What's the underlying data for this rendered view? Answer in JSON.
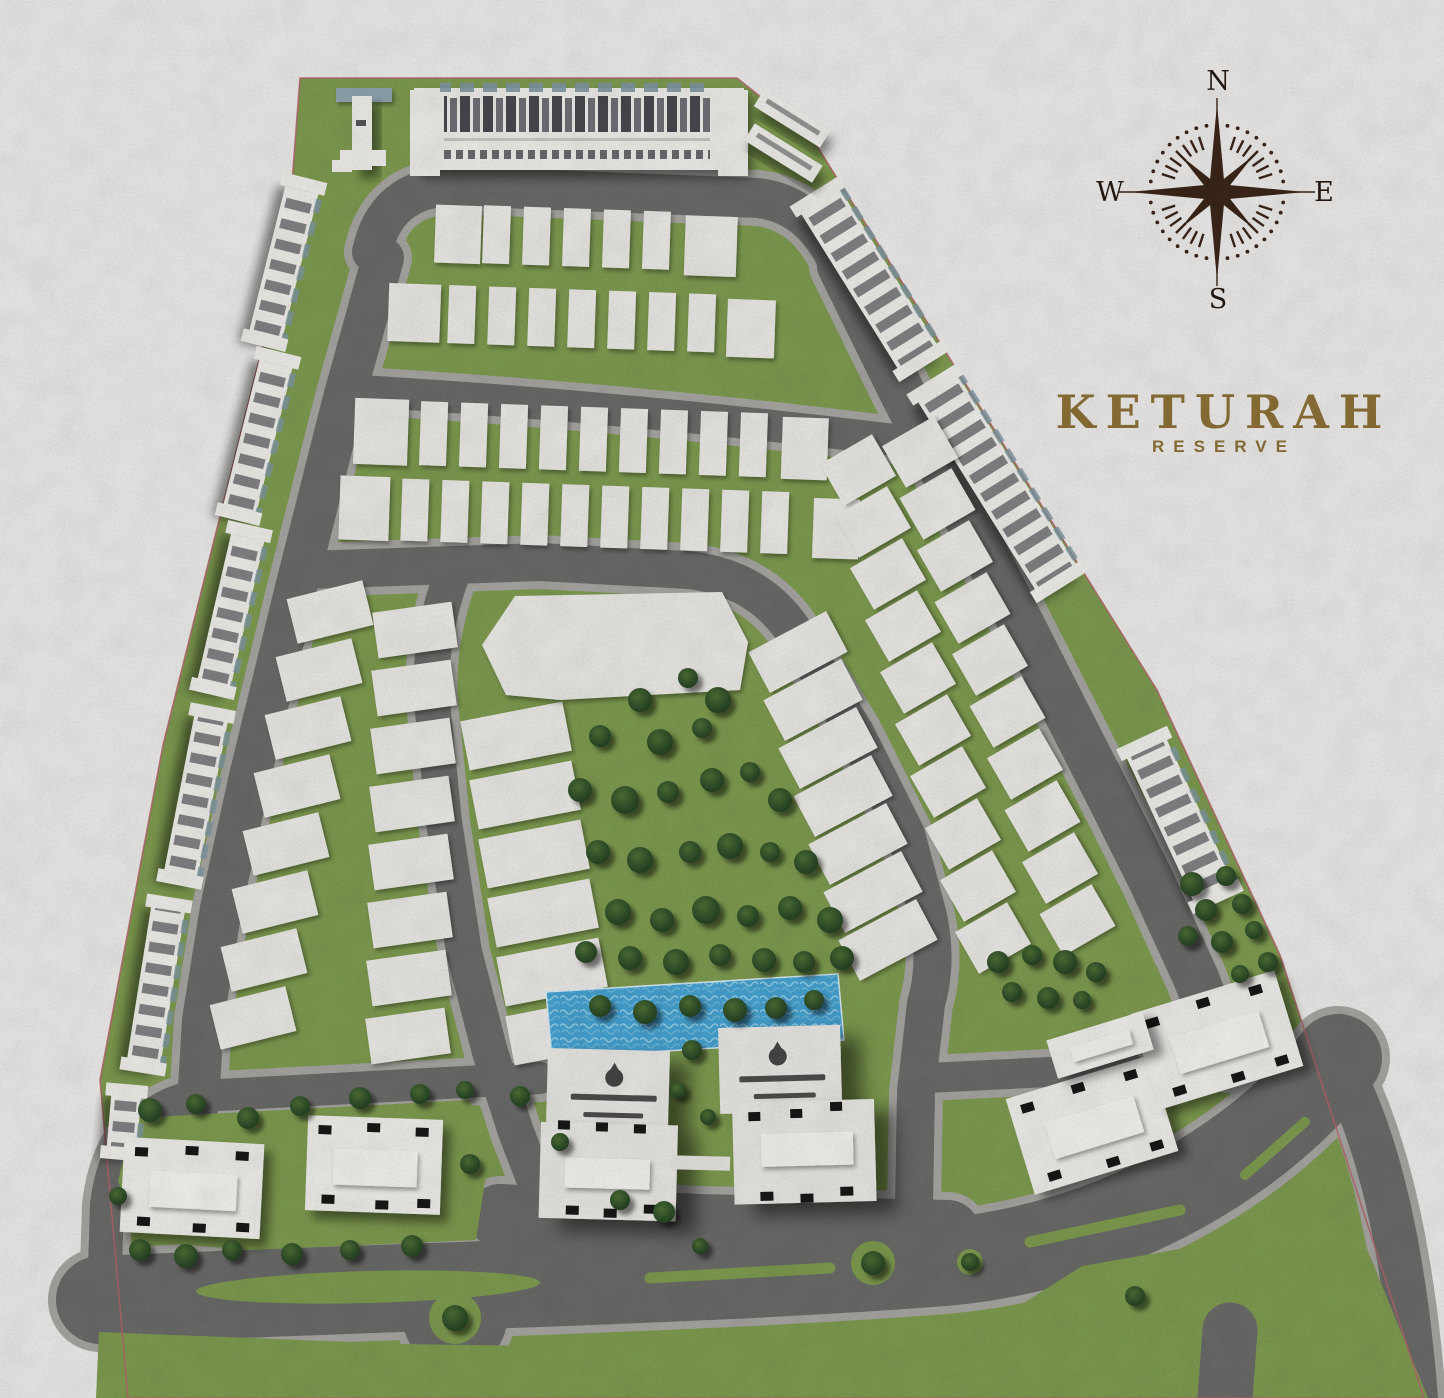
{
  "brand": {
    "title": "KETURAH",
    "subtitle": "RESERVE"
  },
  "compass": {
    "labels": {
      "north": "N",
      "east": "E",
      "south": "S",
      "west": "W"
    }
  },
  "colors": {
    "background": "#edecea",
    "grass": "#7e9b4f",
    "asphalt": "#6a6a68",
    "sidewalk": "#a7a6a2",
    "plot": "#eceae6",
    "building": "#efeeea",
    "window": "#55565b",
    "roof_accent": "#7d96a4",
    "pool": "#45a2d1",
    "pool_light": "#b7e4f5",
    "tree": "#2c4a27",
    "boundary": "#b4646b",
    "compass": "#3a2418",
    "logo": "#8c7036"
  },
  "map": {
    "site_outline_points": "300,78 737,78 812,138 1157,690 1280,955 1424,1398 128,1398 100,1080 163,745 287,248",
    "central_plot_points": "515,596 722,592 748,642 740,690 560,700 506,695 482,645",
    "pool_points": "546,992 838,974 844,1040 552,1058",
    "plot_rows": [
      {
        "lead": [
          436,
          204,
          46,
          58
        ],
        "x": 484,
        "y": 203,
        "w": 27,
        "h": 58,
        "n": 5,
        "p": 40,
        "tail": [
          686,
          206,
          52,
          60
        ]
      },
      {
        "lead": [
          392,
          284,
          52,
          58
        ],
        "x": 452,
        "y": 284,
        "w": 27,
        "h": 58,
        "n": 7,
        "p": 40,
        "tail": [
          731,
          288,
          48,
          58
        ]
      },
      {
        "lead": [
          362,
          400,
          54,
          66
        ],
        "x": 428,
        "y": 401,
        "w": 27,
        "h": 64,
        "n": 9,
        "p": 40,
        "tail": [
          790,
          404,
          46,
          62
        ]
      },
      {
        "lead": [
          350,
          478,
          50,
          64
        ],
        "x": 412,
        "y": 479,
        "w": 27,
        "h": 62,
        "n": 10,
        "p": 40,
        "tail": [
          824,
          484,
          46,
          60
        ]
      }
    ],
    "plot_grids": [
      {
        "cx": 330,
        "cy": 612,
        "dx": -11,
        "dy": 58,
        "n": 8,
        "w": 78,
        "h": 46,
        "rot": -14
      },
      {
        "cx": 415,
        "cy": 630,
        "dx": -1,
        "dy": 58,
        "n": 8,
        "w": 80,
        "h": 46,
        "rot": -8
      },
      {
        "cx": 516,
        "cy": 736,
        "dx": 9,
        "dy": 59,
        "n": 6,
        "w": 104,
        "h": 50,
        "rot": -11
      },
      {
        "cx": 798,
        "cy": 652,
        "dx": 15,
        "dy": 48,
        "n": 7,
        "w": 88,
        "h": 46,
        "rot": -28
      },
      {
        "cx": 858,
        "cy": 470,
        "dx": 15,
        "dy": 52,
        "n": 10,
        "w": 60,
        "h": 48,
        "rot": -30
      },
      {
        "cx": 920,
        "cy": 452,
        "dx": 17.5,
        "dy": 52,
        "n": 10,
        "w": 60,
        "h": 48,
        "rot": -30
      }
    ],
    "strips": [
      {
        "cx": 284,
        "cy": 262,
        "len": 162,
        "w": 34,
        "rot": 104
      },
      {
        "cx": 258,
        "cy": 436,
        "len": 162,
        "w": 34,
        "rot": 104
      },
      {
        "cx": 231,
        "cy": 610,
        "len": 162,
        "w": 34,
        "rot": 103
      },
      {
        "cx": 196,
        "cy": 796,
        "len": 170,
        "w": 34,
        "rot": 101
      },
      {
        "cx": 156,
        "cy": 985,
        "len": 166,
        "w": 34,
        "rot": 99
      },
      {
        "cx": 124,
        "cy": 1122,
        "len": 64,
        "w": 30,
        "rot": 95
      },
      {
        "cx": 869,
        "cy": 279,
        "len": 195,
        "w": 46,
        "rot": 58
      },
      {
        "cx": 997,
        "cy": 483,
        "len": 234,
        "w": 48,
        "rot": 58
      },
      {
        "cx": 1180,
        "cy": 820,
        "len": 170,
        "w": 44,
        "rot": 65
      }
    ],
    "pavilions": [
      {
        "cx": 192,
        "cy": 1188,
        "w": 140,
        "h": 95,
        "rot": 3
      },
      {
        "cx": 374,
        "cy": 1165,
        "w": 135,
        "h": 95,
        "rot": 2
      },
      {
        "cx": 1092,
        "cy": 1125,
        "w": 150,
        "h": 100,
        "rot": -17
      },
      {
        "cx": 1217,
        "cy": 1040,
        "w": 150,
        "h": 100,
        "rot": -17
      },
      {
        "cx": 1100,
        "cy": 1045,
        "w": 100,
        "h": 40,
        "rot": -17,
        "plain": true
      }
    ],
    "trees": [
      [
        640,
        700,
        12
      ],
      [
        688,
        678,
        10
      ],
      [
        718,
        700,
        13
      ],
      [
        600,
        736,
        11
      ],
      [
        660,
        742,
        13
      ],
      [
        702,
        728,
        10
      ],
      [
        580,
        790,
        12
      ],
      [
        625,
        800,
        14
      ],
      [
        668,
        792,
        11
      ],
      [
        712,
        780,
        12
      ],
      [
        750,
        772,
        10
      ],
      [
        780,
        800,
        12
      ],
      [
        598,
        852,
        12
      ],
      [
        640,
        860,
        13
      ],
      [
        690,
        852,
        11
      ],
      [
        730,
        846,
        13
      ],
      [
        770,
        852,
        10
      ],
      [
        806,
        862,
        12
      ],
      [
        618,
        912,
        13
      ],
      [
        662,
        920,
        12
      ],
      [
        706,
        910,
        14
      ],
      [
        748,
        916,
        11
      ],
      [
        790,
        908,
        12
      ],
      [
        830,
        920,
        13
      ],
      [
        586,
        952,
        11
      ],
      [
        630,
        958,
        12
      ],
      [
        676,
        962,
        13
      ],
      [
        720,
        955,
        11
      ],
      [
        764,
        960,
        12
      ],
      [
        804,
        962,
        11
      ],
      [
        842,
        958,
        12
      ],
      [
        600,
        1006,
        11
      ],
      [
        645,
        1012,
        12
      ],
      [
        690,
        1006,
        11
      ],
      [
        735,
        1010,
        12
      ],
      [
        776,
        1008,
        11
      ],
      [
        814,
        1000,
        10
      ],
      [
        692,
        1050,
        10
      ],
      [
        678,
        1090,
        8
      ],
      [
        708,
        1117,
        8
      ],
      [
        150,
        1110,
        12
      ],
      [
        196,
        1104,
        10
      ],
      [
        248,
        1118,
        11
      ],
      [
        300,
        1106,
        10
      ],
      [
        360,
        1098,
        11
      ],
      [
        420,
        1094,
        10
      ],
      [
        465,
        1090,
        9
      ],
      [
        140,
        1250,
        11
      ],
      [
        186,
        1256,
        12
      ],
      [
        232,
        1250,
        10
      ],
      [
        292,
        1254,
        11
      ],
      [
        350,
        1250,
        10
      ],
      [
        412,
        1246,
        11
      ],
      [
        118,
        1196,
        9
      ],
      [
        520,
        1096,
        10
      ],
      [
        470,
        1164,
        10
      ],
      [
        560,
        1142,
        9
      ],
      [
        620,
        1200,
        10
      ],
      [
        664,
        1212,
        11
      ],
      [
        700,
        1246,
        8
      ],
      [
        455,
        1318,
        13
      ],
      [
        873,
        1263,
        12
      ],
      [
        970,
        1262,
        9
      ],
      [
        998,
        962,
        11
      ],
      [
        1032,
        955,
        10
      ],
      [
        1065,
        962,
        12
      ],
      [
        1096,
        972,
        10
      ],
      [
        1012,
        992,
        10
      ],
      [
        1048,
        998,
        11
      ],
      [
        1082,
        1000,
        9
      ],
      [
        1192,
        884,
        12
      ],
      [
        1226,
        876,
        10
      ],
      [
        1206,
        910,
        11
      ],
      [
        1242,
        904,
        10
      ],
      [
        1188,
        936,
        10
      ],
      [
        1222,
        942,
        11
      ],
      [
        1254,
        930,
        9
      ],
      [
        1268,
        962,
        10
      ],
      [
        1240,
        974,
        9
      ],
      [
        1135,
        1296,
        10
      ]
    ]
  }
}
